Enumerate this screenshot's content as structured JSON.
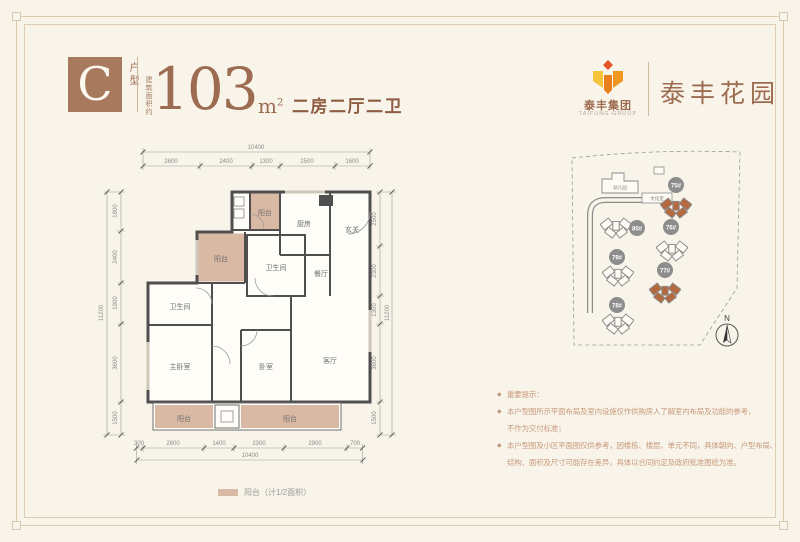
{
  "colors": {
    "background": "#f9f4e9",
    "accent_brown": "#9c6b50",
    "balcony_fill": "#d9b9a3",
    "highlight_building": "#b5693f",
    "logo_yellow": "#f6c33c",
    "logo_orange": "#f09722",
    "logo_red": "#e2542c"
  },
  "header": {
    "type_letter": "C",
    "type_label": "户型",
    "area_prefix": "建筑面积约",
    "area_value": "103",
    "area_unit_base": "m",
    "area_unit_sup": "2",
    "layout_desc": "二房二厅二卫"
  },
  "brand": {
    "group_cn": "泰丰集团",
    "group_en": "TAIFUNG GROUP",
    "project": "泰丰花园"
  },
  "floorplan": {
    "dims_top": {
      "total": "10400",
      "segments": [
        "2600",
        "2400",
        "1300",
        "2500",
        "1600"
      ]
    },
    "dims_left": {
      "total": "11200",
      "segments": [
        "1800",
        "2400",
        "1900",
        "3600",
        "1500"
      ]
    },
    "dims_right": {
      "total": "11200",
      "segments": [
        "2500",
        "2300",
        "1300",
        "3600",
        "1500"
      ]
    },
    "dims_bottom": {
      "total": "10400",
      "segments": [
        "300",
        "2800",
        "1400",
        "2300",
        "2900",
        "700"
      ]
    },
    "rooms": [
      {
        "label": "阳台"
      },
      {
        "label": "厨房"
      },
      {
        "label": "玄关"
      },
      {
        "label": "阳台"
      },
      {
        "label": "卫生间"
      },
      {
        "label": "餐厅"
      },
      {
        "label": "卫生间"
      },
      {
        "label": "主卧室"
      },
      {
        "label": "卧室"
      },
      {
        "label": "客厅"
      },
      {
        "label": "阳台"
      },
      {
        "label": "阳台"
      }
    ]
  },
  "sitemap": {
    "buildings": [
      {
        "id": "75#",
        "highlight": true
      },
      {
        "id": "80#",
        "highlight": false
      },
      {
        "id": "76#",
        "highlight": false
      },
      {
        "id": "79#",
        "highlight": false
      },
      {
        "id": "77#",
        "highlight": true
      },
      {
        "id": "78#",
        "highlight": false
      }
    ],
    "facilities": [
      {
        "label": "幼儿园"
      },
      {
        "label": "文化室"
      }
    ],
    "compass": "N"
  },
  "legend": {
    "label": "阳台（计1/2面积）"
  },
  "disclaimer": {
    "lines": [
      {
        "bullet": true,
        "text": "重要提示："
      },
      {
        "bullet": true,
        "text": "本户型图所示平面布局及室内设施仅作供购房人了解室内布局及功能的参考，"
      },
      {
        "bullet": false,
        "text": "不作为交付标准；"
      },
      {
        "bullet": true,
        "text": "本户型图及小区平面图仅供参考，因楼栋、楼层、单元不同，具体朝向、户型布局、"
      },
      {
        "bullet": false,
        "text": "结构、面积及尺寸可能存在差异，具体以合同约定及政府批准图纸为准。"
      }
    ]
  }
}
